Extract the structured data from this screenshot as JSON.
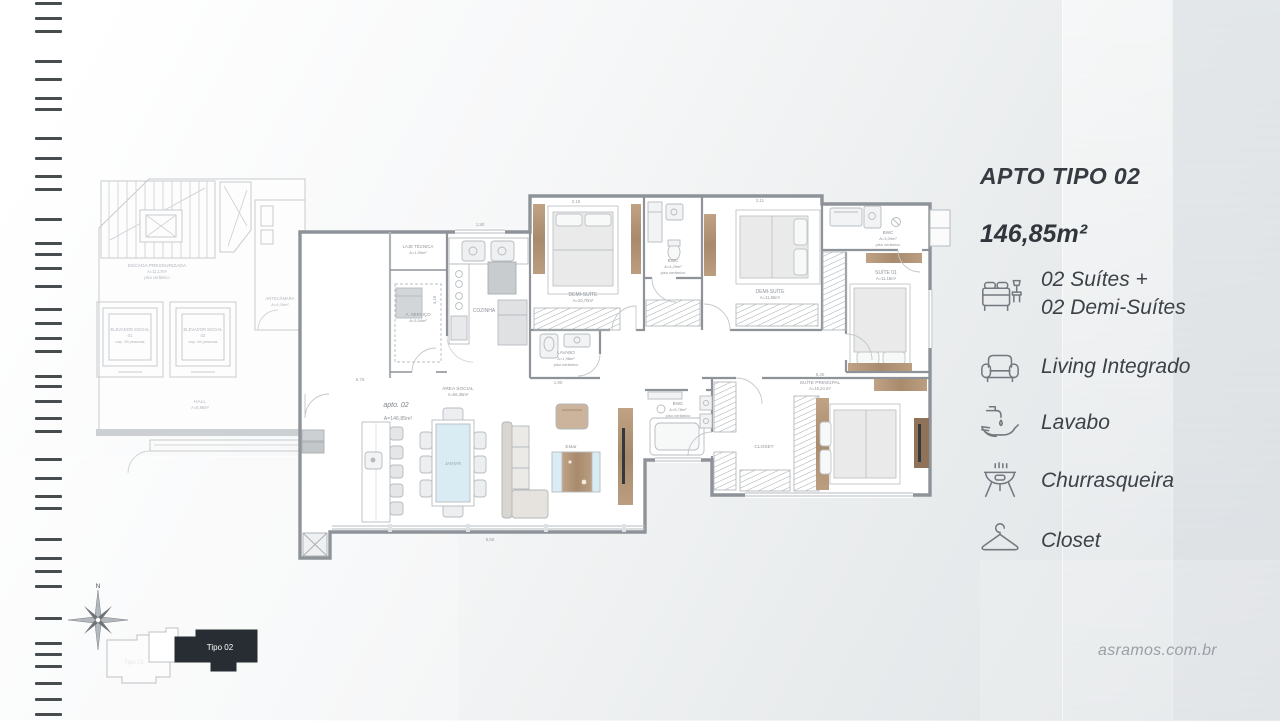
{
  "side_panel": {
    "title": "APTO TIPO 02",
    "area": "146,85m²",
    "features": [
      {
        "icon": "bed-icon",
        "lines": [
          "02 Suítes +",
          "02 Demi-Suítes"
        ]
      },
      {
        "icon": "armchair-icon",
        "lines": [
          "Living Integrado"
        ]
      },
      {
        "icon": "faucet-hand-icon",
        "lines": [
          "Lavabo"
        ]
      },
      {
        "icon": "grill-icon",
        "lines": [
          "Churrasqueira"
        ]
      },
      {
        "icon": "hanger-icon",
        "lines": [
          "Closet"
        ]
      }
    ]
  },
  "footer": {
    "website": "asramos.com.br"
  },
  "keyplan": {
    "compass_north": "N",
    "active_label": "Tipo 02",
    "inactive_label": "Tipo 01"
  },
  "plan": {
    "unit_label": "apto. 02",
    "unit_area": "A=146,85m²",
    "rooms": {
      "escada": {
        "name": "ESCADA PRESSURIZADA",
        "area": "A=11,17m²",
        "floor": "piso cerâmico"
      },
      "elev_social_1": {
        "name": "ELEVADOR SOCIAL",
        "num": "01",
        "cap": "cap. 08 pessoas"
      },
      "elev_social_2": {
        "name": "ELEVADOR SOCIAL",
        "num": "02",
        "cap": "cap. 08 pessoas"
      },
      "antecamara": {
        "name": "ANTECÂMARA",
        "area": "A=4,09m²"
      },
      "hall": {
        "name": "HALL",
        "area": "A=8,95m²"
      },
      "elev_servico_1": {
        "name": "ELEVADOR SERVIÇO",
        "num": "04",
        "cap": "cap. 08 pessoas"
      },
      "elev_servico_2": {
        "name": "ELEVADOR SERVIÇO",
        "num": "03",
        "cap": "cap. 08 pessoas"
      },
      "laje": {
        "name": "LAJE TÉCNICA",
        "area": "A=1,55m²"
      },
      "servico": {
        "name": "A. SERVIÇO",
        "area": "A=3,54m²"
      },
      "cozinha": {
        "name": "COZINHA"
      },
      "area_social": {
        "name": "ÁREA SOCIAL",
        "area": "A=56,35m²"
      },
      "jantar": {
        "name": "JANTAR"
      },
      "estar": {
        "name": "Estar"
      },
      "demi_suite_1": {
        "name": "DEMI-SUÍTE",
        "area": "A=10,70m²"
      },
      "lavabo": {
        "name": "LAVABO",
        "area": "A=1,98m²",
        "floor": "piso cerâmico"
      },
      "bwc_1": {
        "name": "BWC",
        "area": "A=4,29m²",
        "floor": "piso cerâmico"
      },
      "demi_suite_2": {
        "name": "DEMI-SUÍTE",
        "area": "A=11,55m²"
      },
      "bwc_2": {
        "name": "BWC",
        "area": "A=3,09m²",
        "floor": "piso cerâmico"
      },
      "suite_01": {
        "name": "SUÍTE 01",
        "area": "A=11,15m²"
      },
      "bwc_3": {
        "name": "BWC",
        "area": "A=5,76m²",
        "floor": "piso cerâmico"
      },
      "closet": {
        "name": "CLOSET"
      },
      "suite_principal": {
        "name": "SUÍTE PRINCIPAL",
        "area": "A=15,24 m²"
      }
    },
    "dimensions": [
      "2,15",
      "2,11",
      "1,80",
      "5,40",
      "6,60",
      "5,76",
      "4,16",
      "1,90"
    ]
  },
  "colors": {
    "wood_accent": "#b29478",
    "wall": "#8d9398",
    "keyplan_active": "#272d32",
    "text_dark": "#363b42",
    "text_gray": "#9aa0a5"
  }
}
